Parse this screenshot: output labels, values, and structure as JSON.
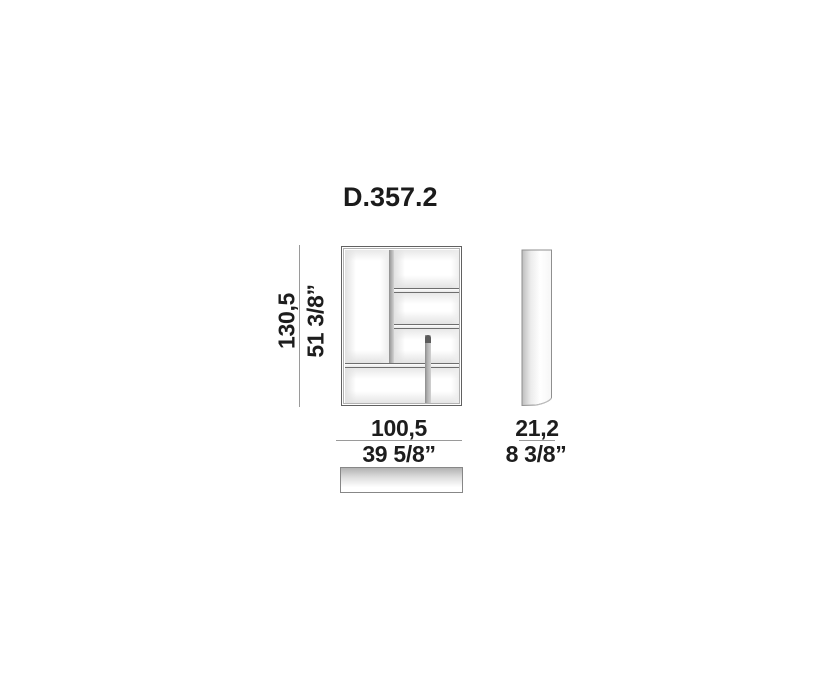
{
  "title": "D.357.2",
  "dimensions": {
    "height": {
      "cm": "130,5",
      "inches": "51 3/8”"
    },
    "width": {
      "cm": "100,5",
      "inches": "39 5/8”"
    },
    "depth": {
      "cm": "21,2",
      "inches": "8 3/8”"
    }
  },
  "colors": {
    "text": "#1d1d1d",
    "dimension_line": "#9a9a9a",
    "drawing_outline": "#616161",
    "panel_gray": "#8f8f8f",
    "background": "#ffffff"
  }
}
